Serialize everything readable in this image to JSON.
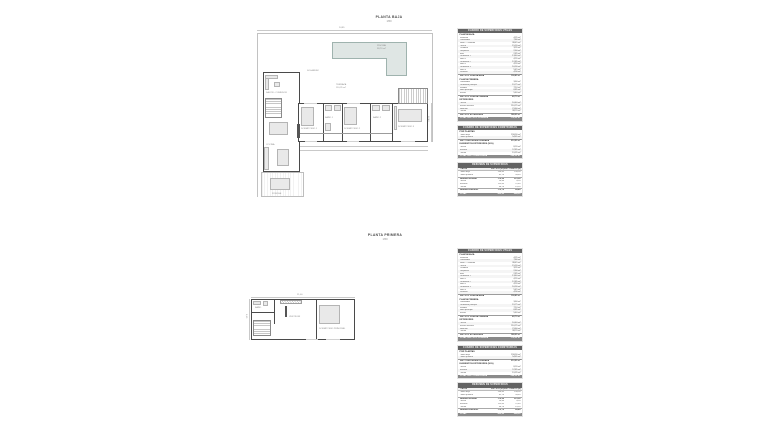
{
  "colors": {
    "pool_fill": "#dfe6e4",
    "pool_border": "#9fb3ae",
    "wall": "#4a4a4a",
    "table_header_bg": "#636363",
    "table_total_bg": "#8a8a8a"
  },
  "plans": {
    "top": {
      "title": "PLANTA BAJA",
      "scale": "1/50",
      "labels": {
        "piscina": "PISCINA",
        "piscina_area": "38,70 m²",
        "terraza": "TERRAZA",
        "terraza_area": "110,25 m²",
        "solarium": "SOLÁRIUM",
        "salon": "SALÓN - COMEDOR",
        "cocina": "COCINA",
        "porche": "PORCHE",
        "dorm1": "DORMITORIO 1",
        "bano1": "BAÑO 1",
        "dorm2": "DORMITORIO 2",
        "bano2": "BAÑO 2",
        "dorm3": "DORMITORIO 3",
        "dim_width": "24,85",
        "dim_height": "12,40"
      }
    },
    "bottom": {
      "title": "PLANTA PRIMERA",
      "scale": "1/50",
      "labels": {
        "dormp": "DORMITORIO PRINCIPAL",
        "vestidor": "VESTIDOR",
        "bano": "BAÑO",
        "dim_width": "21,00",
        "dim_height": "9,10"
      }
    }
  },
  "area_tables": {
    "tables": [
      {
        "header": "CUADRO DE SUPERFICIES ÚTILES",
        "sections": [
          {
            "label": "PLANTA BAJA",
            "rows": [
              [
                "Vestíbulo",
                "4,35 m²"
              ],
              [
                "Distribuidor",
                "7,80 m²"
              ],
              [
                "Salón - Comedor",
                "38,45 m²"
              ],
              [
                "Cocina",
                "15,20 m²"
              ],
              [
                "Lavadero",
                "3,95 m²"
              ],
              [
                "Despensa",
                "2,60 m²"
              ],
              [
                "Aseo",
                "2,85 m²"
              ],
              [
                "Dormitorio 1",
                "13,40 m²"
              ],
              [
                "Baño 1",
                "4,55 m²"
              ],
              [
                "Dormitorio 2",
                "12,85 m²"
              ],
              [
                "Baño 2",
                "4,20 m²"
              ],
              [
                "Dormitorio 3",
                "16,30 m²"
              ],
              [
                "Baño 3",
                "5,45 m²"
              ],
              [
                "Escalera",
                "4,90 m²"
              ]
            ],
            "subtotal": [
              "SUP. ÚTIL PLANTA BAJA",
              "136,85 m²"
            ]
          },
          {
            "label": "PLANTA PRIMERA",
            "rows": [
              [
                "Distribuidor",
                "3,60 m²"
              ],
              [
                "Dormitorio principal",
                "19,75 m²"
              ],
              [
                "Vestidor",
                "7,10 m²"
              ],
              [
                "Baño principal",
                "6,85 m²"
              ],
              [
                "Terraza",
                "5,40 m²"
              ]
            ],
            "subtotal": [
              "SUP. ÚTIL PLANTA PRIMERA",
              "42,70 m²"
            ]
          },
          {
            "label": "EXTERIORES",
            "rows": [
              [
                "Porche",
                "16,40 m²"
              ],
              [
                "Terraza exterior",
                "110,25 m²"
              ],
              [
                "Solárium",
                "21,60 m²"
              ],
              [
                "Piscina",
                "38,70 m²"
              ]
            ],
            "subtotal": [
              "SUP. ÚTIL EXTERIORES",
              "186,95 m²"
            ]
          }
        ],
        "total": [
          "TOTAL SUP. ÚTIL VIVIENDA",
          "179,55 m²"
        ]
      },
      {
        "header": "CUADRO DE SUPERFICIES CONSTRUIDAS",
        "sections": [
          {
            "label": "POR PLANTAS",
            "rows": [
              [
                "Planta baja",
                "158,30 m²"
              ],
              [
                "Planta primera",
                "54,65 m²"
              ]
            ],
            "subtotal": [
              "SUP. CONSTRUIDA CERRADA",
              "212,95 m²"
            ]
          },
          {
            "label": "ELEMENTOS EXTERIORES (50%)",
            "rows": [
              [
                "Porche",
                "8,20 m²"
              ],
              [
                "Terrazas",
                "57,85 m²"
              ],
              [
                "Piscina",
                "19,35 m²"
              ]
            ]
          }
        ],
        "total": [
          "TOTAL SUP. CONSTRUIDA",
          "298,35 m²"
        ]
      },
      {
        "header": "RESUMEN DE SUPERFICIES",
        "columns": [
          "PLANTA",
          "SUP. ÚTIL (m²)",
          "SUP. CONSTR. (m²)"
        ],
        "rows": [
          {
            "label": "Planta baja",
            "u": "136,85",
            "c": "158,30"
          },
          {
            "label": "Planta primera",
            "u": "42,70",
            "c": "54,65"
          },
          {
            "label": "Subtotal vivienda",
            "u": "179,55",
            "c": "212,95",
            "bold": true
          },
          {
            "label": "Porche",
            "u": "16,40",
            "c": "8,20"
          },
          {
            "label": "Terrazas",
            "u": "115,65",
            "c": "57,85"
          },
          {
            "label": "Piscina",
            "u": "38,70",
            "c": "19,35"
          },
          {
            "label": "Subtotal exteriores",
            "u": "170,75",
            "c": "85,40",
            "bold": true
          }
        ],
        "total": {
          "label": "TOTAL",
          "u": "350,30",
          "c": "298,35"
        }
      }
    ]
  }
}
